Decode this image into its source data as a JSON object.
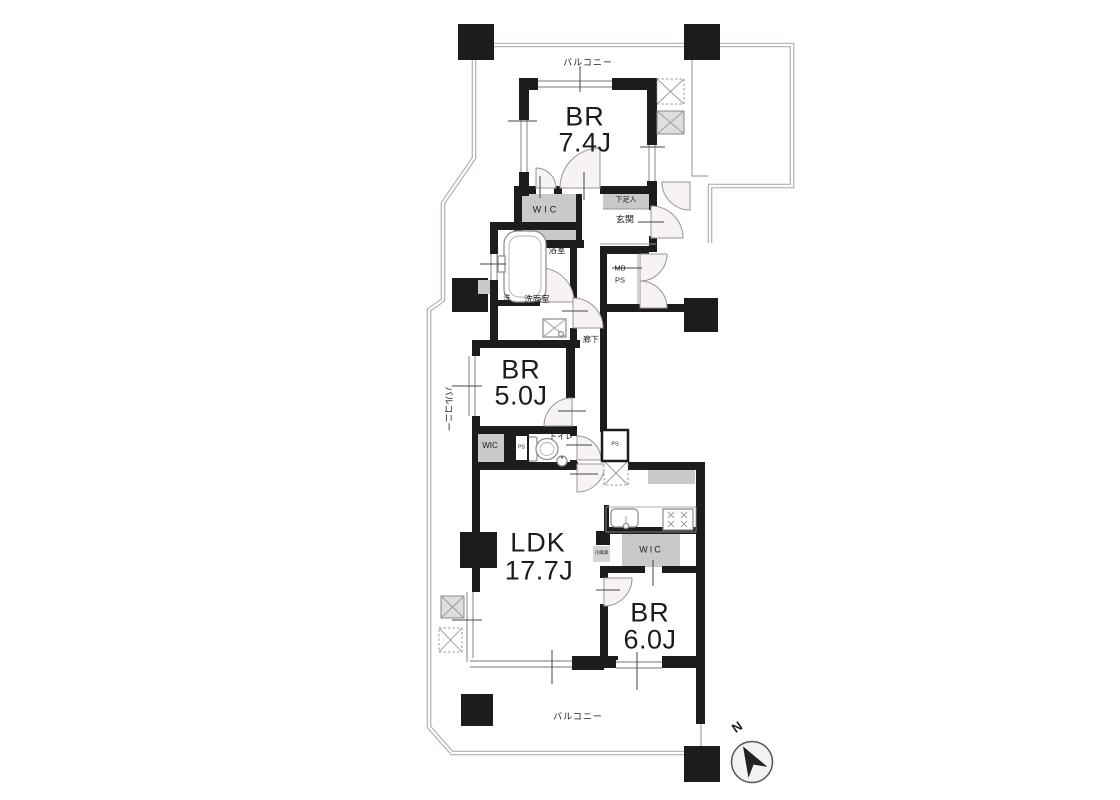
{
  "colors": {
    "wall": "#1c1c1c",
    "closet_fill": "#c9c9c9",
    "boundary_line": "#b6aeae",
    "door_fill": "#f6f3f2",
    "door_stroke": "#9b9494",
    "fixture_stroke": "#8a8a8a",
    "hatch_fill": "#dedede",
    "text": "#1c1c1c"
  },
  "rooms": {
    "bedroom1": {
      "name": "BR",
      "size": "7.4J"
    },
    "bedroom2": {
      "name": "BR",
      "size": "5.0J"
    },
    "living": {
      "name": "LDK",
      "size": "17.7J"
    },
    "bedroom3": {
      "name": "BR",
      "size": "6.0J"
    }
  },
  "labels": {
    "balcony_top": "バルコニー",
    "balcony_left": "バルコニー",
    "balcony_bottom": "バルコニー",
    "wic1": "WIC",
    "wic2": "WIC",
    "wic3": "WIC",
    "shoe_cabinet": "下足入",
    "entrance": "玄関",
    "meter_box": "MB",
    "pipe_space": "PS",
    "pipe_space_small": "PS",
    "pipe_space_right": "PS",
    "bathroom": "浴室",
    "washer": "洗",
    "washroom": "洗面室",
    "hallway": "廊下",
    "toilet": "トイレ",
    "refrigerator": "冷蔵庫",
    "compass_north": "N"
  }
}
